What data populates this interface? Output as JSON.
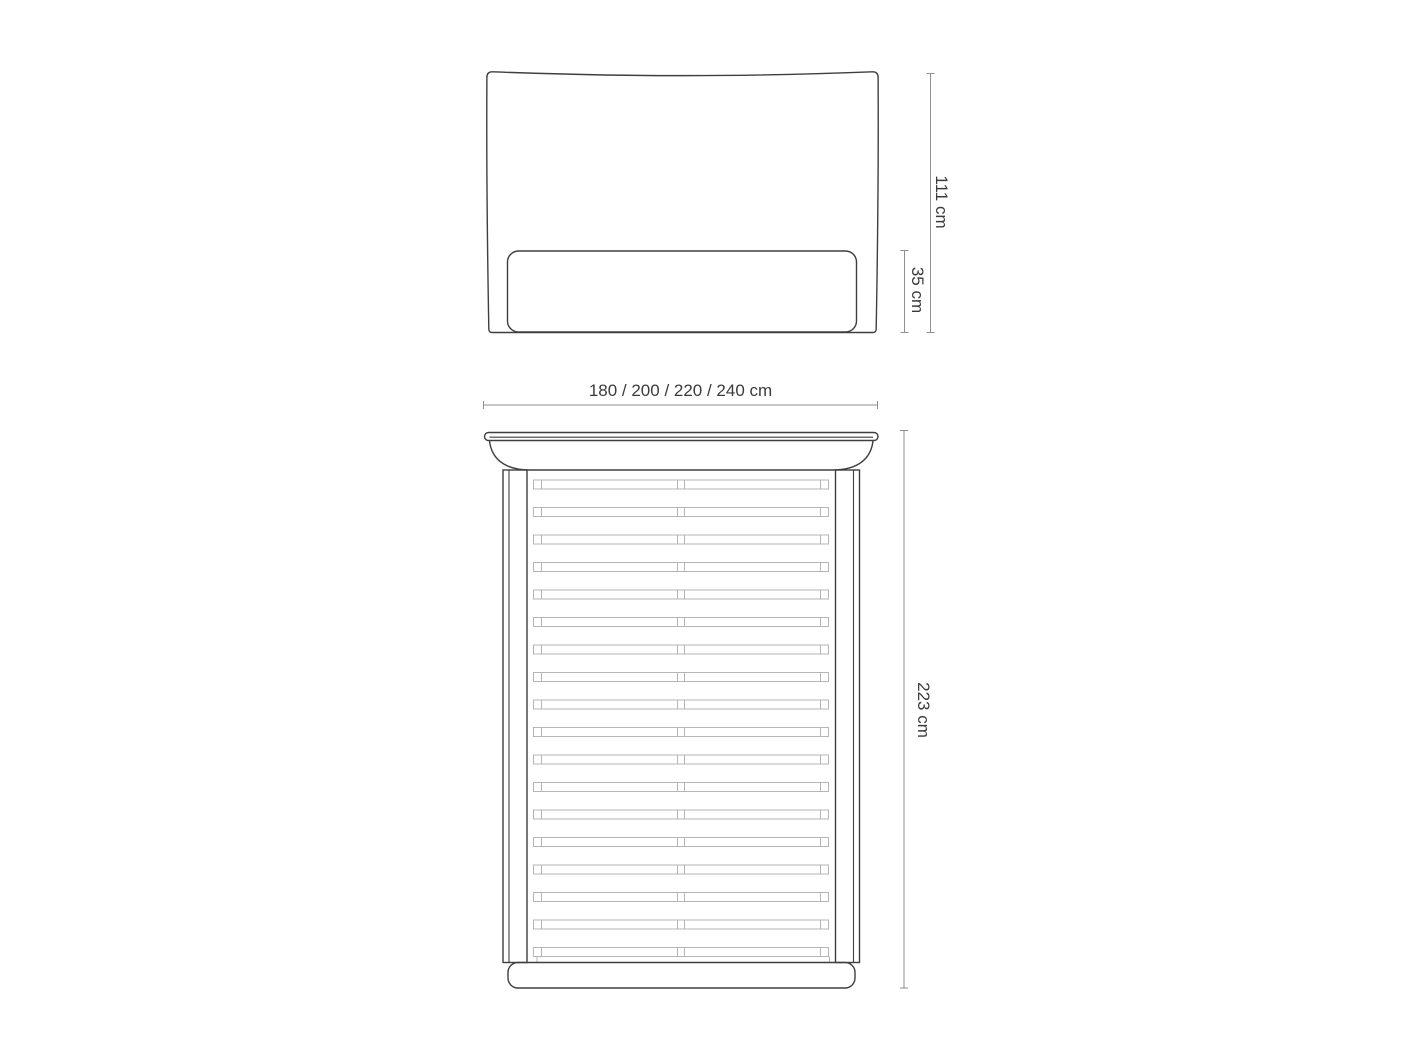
{
  "diagram": {
    "type": "furniture-dimension-drawing",
    "subject": "bed-frame",
    "front_view": {
      "height_total_label": "111 cm",
      "base_height_label": "35 cm"
    },
    "plan_view": {
      "width_label": "180 / 200 / 220 / 240 cm",
      "length_label": "223 cm",
      "slat_count": 18,
      "slats_per_row": 2
    },
    "colors": {
      "background": "#ffffff",
      "outline": "#3f3f3f",
      "dimension_line": "#8f8f8f",
      "slat_line": "#b5b5b5",
      "text": "#3b3b3b"
    }
  }
}
